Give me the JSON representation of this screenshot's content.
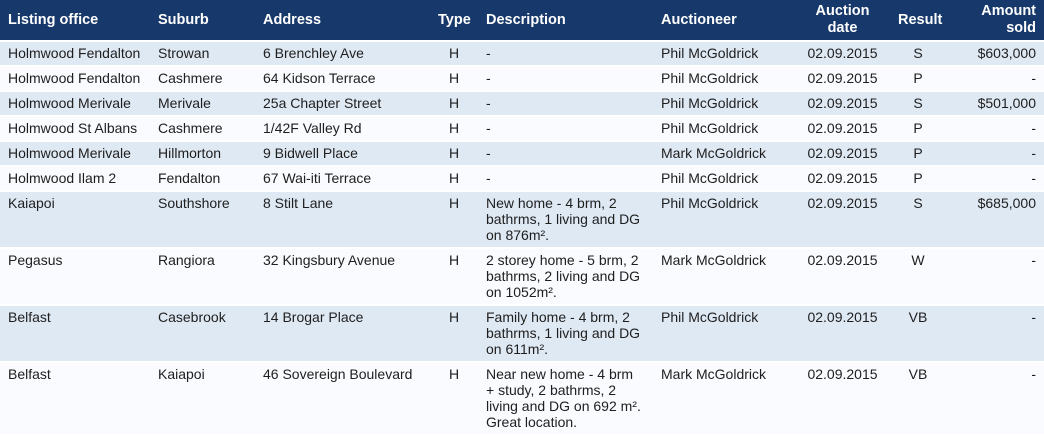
{
  "colors": {
    "header_bg": "#17386a",
    "header_text": "#ffffff",
    "row_stripe": "#dfe9f4",
    "row_alt": "#f9fbfe",
    "text": "#1e1e1e",
    "separator": "#ffffff"
  },
  "chart_data": {
    "type": "table",
    "columns": [
      "Listing office",
      "Suburb",
      "Address",
      "Type",
      "Description",
      "Auctioneer",
      "Auction date",
      "Result",
      "Amount sold"
    ],
    "rows": [
      [
        "Holmwood Fendalton",
        "Strowan",
        "6 Brenchley Ave",
        "H",
        "-",
        "Phil McGoldrick",
        "02.09.2015",
        "S",
        "$603,000"
      ],
      [
        "Holmwood Fendalton",
        "Cashmere",
        "64 Kidson Terrace",
        "H",
        "-",
        "Phil McGoldrick",
        "02.09.2015",
        "P",
        "-"
      ],
      [
        "Holmwood Merivale",
        "Merivale",
        "25a Chapter Street",
        "H",
        "-",
        "Phil McGoldrick",
        "02.09.2015",
        "S",
        "$501,000"
      ],
      [
        "Holmwood St Albans",
        "Cashmere",
        "1/42F Valley Rd",
        "H",
        "-",
        "Phil McGoldrick",
        "02.09.2015",
        "P",
        "-"
      ],
      [
        "Holmwood Merivale",
        "Hillmorton",
        "9 Bidwell Place",
        "H",
        "-",
        "Mark McGoldrick",
        "02.09.2015",
        "P",
        "-"
      ],
      [
        "Holmwood Ilam 2",
        "Fendalton",
        "67 Wai-iti Terrace",
        "H",
        "-",
        "Phil McGoldrick",
        "02.09.2015",
        "P",
        "-"
      ],
      [
        "Kaiapoi",
        "Southshore",
        "8 Stilt Lane",
        "H",
        "New home - 4 brm, 2 bathrms, 1 living and DG on 876m².",
        "Phil McGoldrick",
        "02.09.2015",
        "S",
        "$685,000"
      ],
      [
        "Pegasus",
        "Rangiora",
        "32 Kingsbury Avenue",
        "H",
        "2 storey home - 5 brm, 2 bathrms, 2 living and DG on 1052m².",
        "Mark McGoldrick",
        "02.09.2015",
        "W",
        "-"
      ],
      [
        "Belfast",
        "Casebrook",
        "14 Brogar Place",
        "H",
        "Family home - 4 brm, 2 bathrms, 1 living and DG on 611m².",
        "Phil McGoldrick",
        "02.09.2015",
        "VB",
        "-"
      ],
      [
        "Belfast",
        "Kaiapoi",
        "46 Sovereign Boulevard",
        "H",
        "Near new home - 4 brm + study, 2 bathrms, 2 living and DG on 692 m². Great location.",
        "Mark McGoldrick",
        "02.09.2015",
        "VB",
        "-"
      ]
    ]
  }
}
